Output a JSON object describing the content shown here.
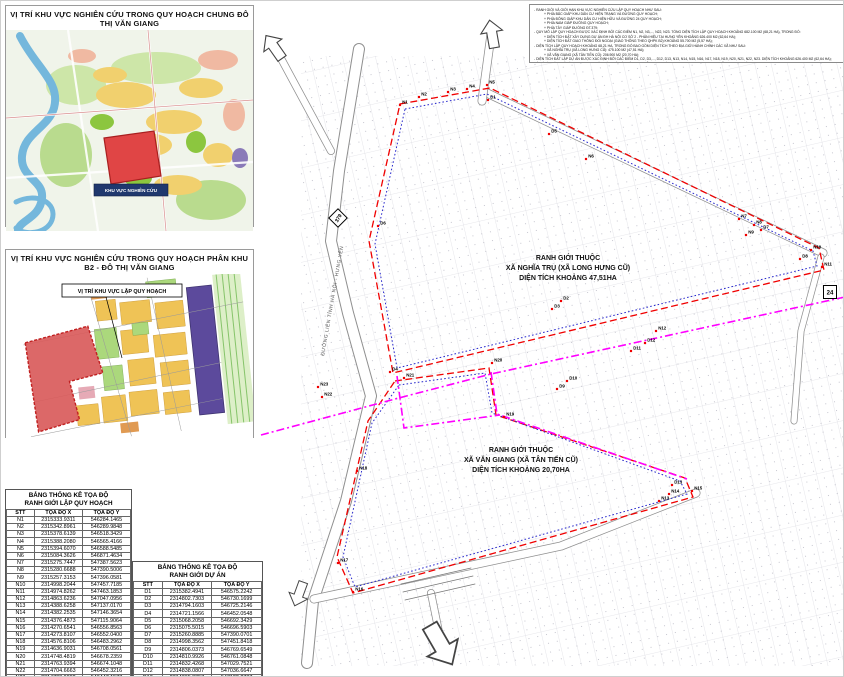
{
  "inset1": {
    "title": "VỊ TRÍ KHU VỰC NGHIÊN CỨU TRONG QUY HOẠCH CHUNG ĐÔ THỊ VĂN GIANG",
    "label_box": "KHU VỰC NGHIÊN CỨU"
  },
  "inset2": {
    "title": "VỊ TRÍ KHU VỰC NGHIÊN CỨU TRONG QUY HOẠCH PHÂN KHU B2 - ĐÔ THỊ VĂN GIANG",
    "callout": "VỊ TRÍ KHU VỰC LẬP QUY HOẠCH"
  },
  "notes": {
    "lines": [
      "- RANH GIỚI VÀ GIỚI HẠN KHU VỰC NGHIÊN CỨU LẬP QUY HOẠCH NHƯ SAU:",
      "+ PHÍA BẮC GIÁP KHU DÂN CƯ HIỆN TRẠNG VÀ ĐƯỜNG QUY HOẠCH;",
      "+ PHÍA ĐÔNG GIÁP KHU DÂN CƯ HIỆN HỮU VÀ ĐƯỜNG 24 QUY HOẠCH;",
      "+ PHÍA NAM GIÁP ĐƯỜNG QUY HOẠCH;",
      "+ PHÍA TÂY GIÁP ĐƯỜNG ĐT.379;",
      "- QUY MÔ LẬP QUY HOẠCH ĐƯỢC XÁC ĐỊNH BỞI CÁC ĐIỂM N1, N2, N3,..., N22, N23. TỔNG DIỆN TÍCH LẬP QUY HOẠCH KHOẢNG 682.100 M2 (68,21 HA), TRONG ĐÓ:",
      "+ DIỆN TÍCH ĐẤT XÂY DỰNG DỰ ÁN ĐH HÀ NỘI CƠ SỞ 2 - PHÂN HIỆU TẠI HƯNG YÊN KHOẢNG 626.400 M2 (62,64 HA);",
      "+ DIỆN TÍCH ĐẤT GIAO THÔNG ĐỐI NGOẠI (GIAO THÔNG THEO QHPK B2) KHOẢNG 55.700 M2 (5,57 HA);",
      "- DIỆN TÍCH LẬP QUY HOẠCH KHOẢNG 68,21 HA, TRONG ĐÓ BAO GỒM DIỆN TÍCH THEO ĐỊA GIỚI HÀNH CHÍNH CÁC XÃ NHƯ SAU:",
      "+ XÃ NGHĨA TRỤ (XÃ LONG HƯNG CŨ): 475.100 M2 (47,51 HA);",
      "+ XÃ VĂN GIANG (XÃ TÂN TIẾN CŨ): 206.900 M2 (20,70 HA);",
      "- DIỆN TÍCH ĐẤT LẬP DỰ ÁN ĐƯỢC XÁC ĐỊNH BỞI CÁC ĐIỂM D1, D2, D3,..., D12, D13, N13, N14, N15, N16, N17, N18, N19, N20, N21, N22, N23. DIỆN TÍCH KHOẢNG 626.400 M2 (62,64 HA);",
      "- Ở ĐỒ ÁN NÀY CHỈ XÁC ĐỊNH RANH GIỚI; CÁC CHỈ TIÊU SỬ DỤNG ĐẤT ĐƯỢC XÁC ĐỊNH THEO QUY HOẠCH CHI TIẾT ĐƯỢC DUYỆT."
    ]
  },
  "main_map": {
    "region1": {
      "line1": "RANH GIỚI THUỘC",
      "line2": "XÃ NGHĨA TRỤ (XÃ LONG HƯNG CŨ)",
      "line3": "DIỆN TÍCH KHOẢNG 47,51HA"
    },
    "region2": {
      "line1": "RANH GIỚI THUỘC",
      "line2": "XÃ VĂN GIANG (XÃ TÂN TIẾN CŨ)",
      "line3": "DIỆN TÍCH KHOẢNG 20,70HA"
    },
    "road_badge_379": "379",
    "road_badge_24": "24",
    "road_label": "ĐƯỜNG LIÊN TỈNH HÀ NỘI - HƯNG YÊN",
    "points": [
      {
        "label": "N1",
        "x": 399,
        "y": 104
      },
      {
        "label": "N2",
        "x": 418,
        "y": 96
      },
      {
        "label": "N3",
        "x": 447,
        "y": 91
      },
      {
        "label": "N4",
        "x": 466,
        "y": 88
      },
      {
        "label": "N5",
        "x": 486,
        "y": 84
      },
      {
        "label": "N6",
        "x": 585,
        "y": 158
      },
      {
        "label": "N7",
        "x": 738,
        "y": 218
      },
      {
        "label": "N8",
        "x": 753,
        "y": 224
      },
      {
        "label": "N9",
        "x": 745,
        "y": 234
      },
      {
        "label": "N10",
        "x": 810,
        "y": 249
      },
      {
        "label": "N11",
        "x": 821,
        "y": 266
      },
      {
        "label": "N12",
        "x": 655,
        "y": 330
      },
      {
        "label": "N13",
        "x": 658,
        "y": 500
      },
      {
        "label": "N14",
        "x": 668,
        "y": 493
      },
      {
        "label": "N15",
        "x": 691,
        "y": 490
      },
      {
        "label": "N16",
        "x": 352,
        "y": 591
      },
      {
        "label": "N17",
        "x": 337,
        "y": 562
      },
      {
        "label": "N18",
        "x": 356,
        "y": 470
      },
      {
        "label": "N19",
        "x": 503,
        "y": 416
      },
      {
        "label": "N20",
        "x": 491,
        "y": 362
      },
      {
        "label": "N21",
        "x": 403,
        "y": 377
      },
      {
        "label": "N22",
        "x": 321,
        "y": 396
      },
      {
        "label": "N23",
        "x": 317,
        "y": 386
      },
      {
        "label": "D1",
        "x": 487,
        "y": 99
      },
      {
        "label": "D2",
        "x": 560,
        "y": 300
      },
      {
        "label": "D3",
        "x": 551,
        "y": 308
      },
      {
        "label": "D4",
        "x": 389,
        "y": 371
      },
      {
        "label": "D5",
        "x": 548,
        "y": 133
      },
      {
        "label": "D6",
        "x": 377,
        "y": 225
      },
      {
        "label": "D7",
        "x": 760,
        "y": 229
      },
      {
        "label": "D8",
        "x": 799,
        "y": 258
      },
      {
        "label": "D9",
        "x": 556,
        "y": 388
      },
      {
        "label": "D10",
        "x": 566,
        "y": 380
      },
      {
        "label": "D11",
        "x": 630,
        "y": 350
      },
      {
        "label": "D12",
        "x": 644,
        "y": 342
      },
      {
        "label": "D13",
        "x": 671,
        "y": 484
      }
    ]
  },
  "tables": [
    {
      "title_line1": "BẢNG THỐNG KÊ TỌA ĐỘ",
      "title_line2": "RANH GIỚI LẬP QUY HOẠCH",
      "headers": [
        "STT",
        "TỌA ĐỘ X",
        "TỌA ĐỘ Y"
      ],
      "rows": [
        [
          "N1",
          "2315333.9311",
          "546284.1465"
        ],
        [
          "N2",
          "2315342.8961",
          "546289.9848"
        ],
        [
          "N3",
          "2315378.6139",
          "546518.3429"
        ],
        [
          "N4",
          "2315388.2080",
          "546565.4166"
        ],
        [
          "N5",
          "2315394.6070",
          "546588.5485"
        ],
        [
          "N6",
          "2315084.3626",
          "546871.4634"
        ],
        [
          "N7",
          "2315275.7447",
          "547387.5623"
        ],
        [
          "N8",
          "2315280.6688",
          "547390.5006"
        ],
        [
          "N9",
          "2315257.3153",
          "547396.0581"
        ],
        [
          "N10",
          "2314998.2044",
          "547457.7185"
        ],
        [
          "N11",
          "2314974.8262",
          "547463.1853"
        ],
        [
          "N12",
          "2314863.6236",
          "547047.0956"
        ],
        [
          "N13",
          "2314388.6258",
          "547137.0170"
        ],
        [
          "N14",
          "2314382.2535",
          "547146.3654"
        ],
        [
          "N15",
          "2314376.4873",
          "547115.9064"
        ],
        [
          "N16",
          "2314270.6541",
          "546556.8563"
        ],
        [
          "N17",
          "2314273.8107",
          "546552.0400"
        ],
        [
          "N18",
          "2314576.8106",
          "546483.2962"
        ],
        [
          "N19",
          "2314636.9031",
          "546708.0561"
        ],
        [
          "N20",
          "2314748.4819",
          "546678.2359"
        ],
        [
          "N21",
          "2314763.9394",
          "546674.1048"
        ],
        [
          "N22",
          "2314704.6663",
          "546452.3216"
        ],
        [
          "N23",
          "2314723.9882",
          "546447.1577"
        ]
      ]
    },
    {
      "title_line1": "BẢNG THỐNG KÊ TỌA ĐỘ",
      "title_line2": "RANH GIỚI DỰ ÁN",
      "headers": [
        "STT",
        "TỌA ĐỘ X",
        "TỌA ĐỘ Y"
      ],
      "rows": [
        [
          "D1",
          "2315382.4941",
          "546575.2242"
        ],
        [
          "D2",
          "2314802.7303",
          "546730.1699"
        ],
        [
          "D3",
          "2314794.1603",
          "546725.2146"
        ],
        [
          "D4",
          "2314721.1566",
          "546452.0548"
        ],
        [
          "D5",
          "2315068.2058",
          "546692.3429"
        ],
        [
          "D6",
          "2315075.5015",
          "546696.5903"
        ],
        [
          "D7",
          "2315260.8885",
          "547390.0701"
        ],
        [
          "D8",
          "2314998.3562",
          "547451.8418"
        ],
        [
          "D9",
          "2314806.0373",
          "546769.6549"
        ],
        [
          "D10",
          "2314810.9926",
          "546761.0848"
        ],
        [
          "D11",
          "2314832.4268",
          "547029.7521"
        ],
        [
          "D12",
          "2314838.0807",
          "547036.6647"
        ],
        [
          "D13",
          "2314365.8357",
          "547122.2787"
        ]
      ]
    }
  ],
  "colors": {
    "boundary_red": "#f00000",
    "boundary_blue": "#2828cc",
    "admin_magenta": "#ff00ff",
    "highlight_red": "#d95b5b",
    "purple_block": "#5c4a9c",
    "parcel_yellow": "#efc356"
  }
}
